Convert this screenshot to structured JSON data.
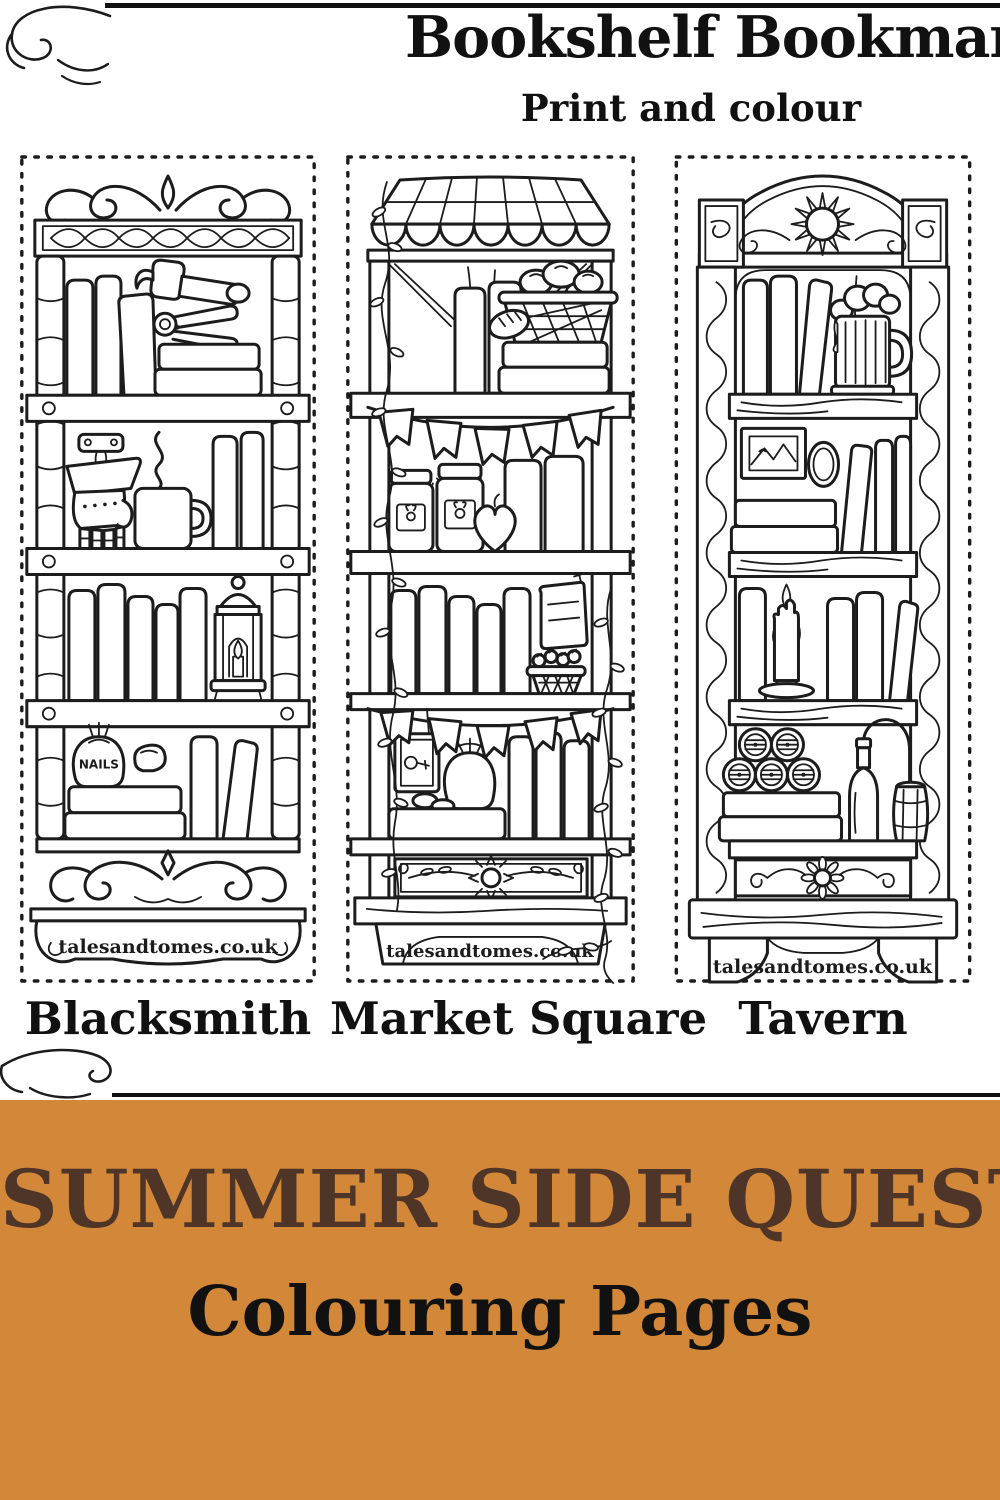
{
  "page": {
    "background": "#ffffff",
    "title": "Bookshelf Bookmarks",
    "subtitle": "Print and colour"
  },
  "bookmarks": [
    {
      "label": "Blacksmith",
      "website": "talesandtomes.co.uk",
      "sack_label": "NAILS",
      "items": [
        "scrollwork-crest",
        "stone-columns",
        "books",
        "hammer",
        "tongs",
        "stacked-books",
        "wall-mount",
        "hanging-gauntlet",
        "steaming-mug",
        "candle-lantern",
        "nails-sack",
        "stone",
        "scrollwork-footer"
      ]
    },
    {
      "label": "Market Square",
      "website": "talesandtomes.co.uk",
      "items": [
        "striped-awning",
        "ivy-vine",
        "bread-basket",
        "books",
        "stacked-books",
        "bunting-flags",
        "jam-jars",
        "heart-apple",
        "hanging-parchment",
        "strawberry-basket",
        "hanging-sign",
        "coin-pouch",
        "coins",
        "floral-panel"
      ]
    },
    {
      "label": "Tavern",
      "website": "talesandtomes.co.uk",
      "items": [
        "sun-carving",
        "carved-columns",
        "books",
        "frothy-tankard",
        "framed-painting",
        "mirror",
        "melting-candle",
        "barrel-kegs",
        "flagon",
        "barrel",
        "sunflower-panel"
      ]
    }
  ],
  "banner": {
    "background": "#d28838",
    "line1": "SUMMER SIDE QUEST",
    "line1_color": "#4e3527",
    "line2": "Colouring Pages",
    "line2_color": "#111111"
  }
}
